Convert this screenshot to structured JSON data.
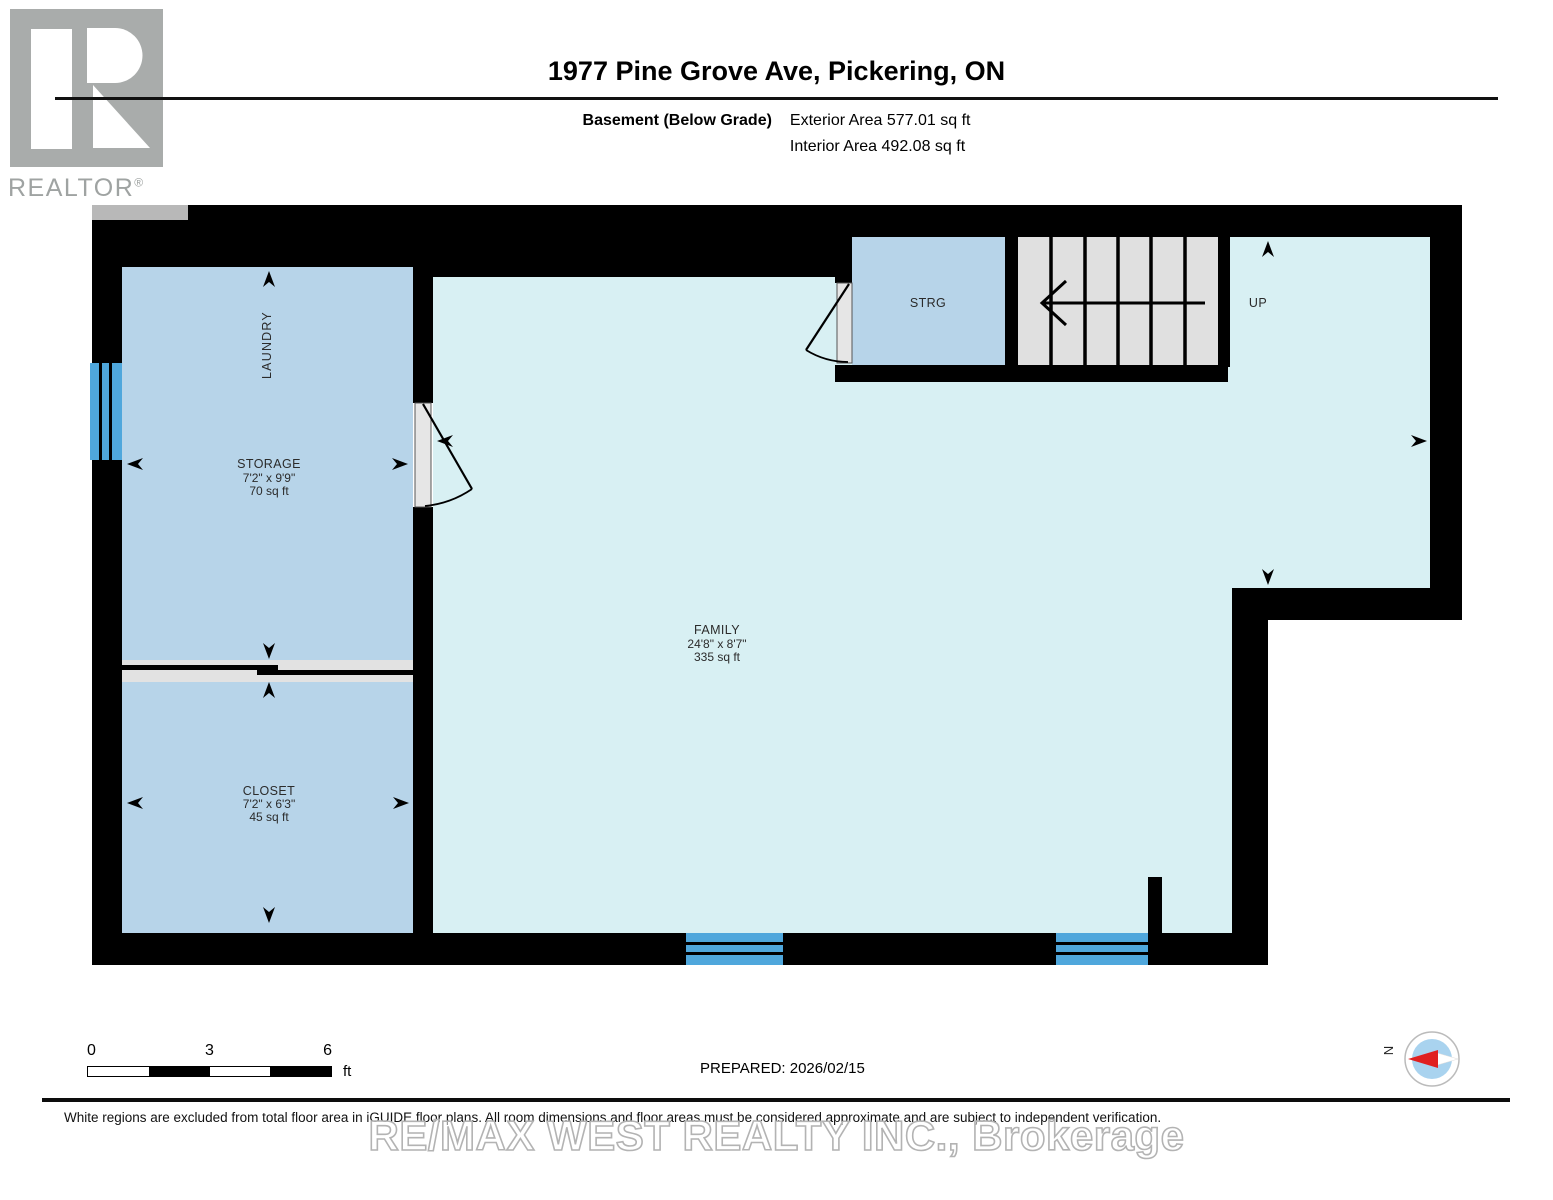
{
  "header": {
    "logo_brand": "REALTOR",
    "logo_registered": "®",
    "title": "1977 Pine Grove Ave, Pickering, ON",
    "floor_label": "Basement (Below Grade)",
    "exterior_area": "Exterior Area 577.01 sq ft",
    "interior_area": "Interior Area 492.08 sq ft"
  },
  "plan": {
    "rooms": {
      "laundry": {
        "label": "LAUNDRY"
      },
      "storage": {
        "label": "STORAGE",
        "dimensions": "7'2\" x 9'9\"",
        "area": "70 sq ft"
      },
      "closet": {
        "label": "CLOSET",
        "dimensions": "7'2\" x 6'3\"",
        "area": "45 sq ft"
      },
      "family": {
        "label": "FAMILY",
        "dimensions": "24'8\" x 8'7\"",
        "area": "335 sq ft"
      },
      "strg": {
        "label": "STRG"
      }
    },
    "stairs_direction": "UP",
    "colors": {
      "wall": "#000000",
      "room_blue": "#B7D4E9",
      "room_cyan": "#D8F0F3",
      "window_blue": "#4FA7DC",
      "stair_gray": "#E0E0E0",
      "divider_gray": "#E2E2E2",
      "door_gray": "#E6E6E6"
    }
  },
  "footer": {
    "scale_ticks": [
      "0",
      "3",
      "6"
    ],
    "scale_unit": "ft",
    "prepared": "PREPARED: 2026/02/15",
    "compass_label": "N",
    "disclaimer": "White regions are excluded from total floor area in iGUIDE floor plans. All room dimensions and floor areas must be considered approximate and are subject to independent verification.",
    "watermark": "RE/MAX WEST REALTY INC., Brokerage"
  }
}
